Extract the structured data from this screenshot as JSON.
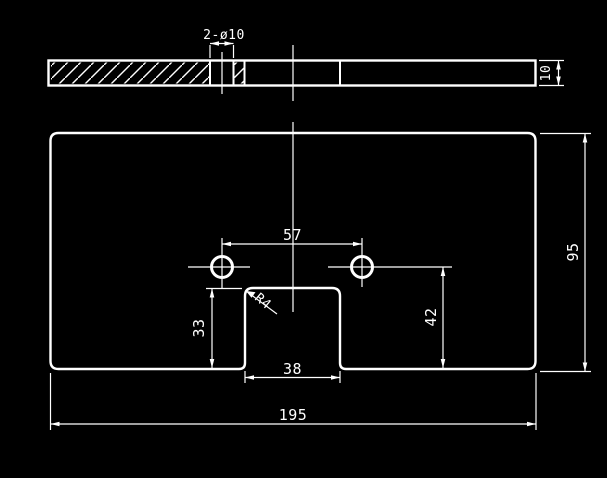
{
  "drawing": {
    "type": "cad-technical-drawing",
    "background_color": "#000000",
    "line_color": "#ffffff",
    "top_view": {
      "description": "sectioned top/edge view of plate with hatching",
      "holes_dim_label": "2-ø10",
      "thickness_dim_label": "10"
    },
    "front_view": {
      "description": "plate outline with two holes and bottom center notch",
      "hole_spacing_dim_label": "57",
      "plate_height_dim_label": "95",
      "hole_to_bottom_dim_label": "42",
      "notch_height_dim_label": "33",
      "notch_width_dim_label": "38",
      "plate_width_dim_label": "195",
      "fillet_radius_label": "R4"
    }
  }
}
